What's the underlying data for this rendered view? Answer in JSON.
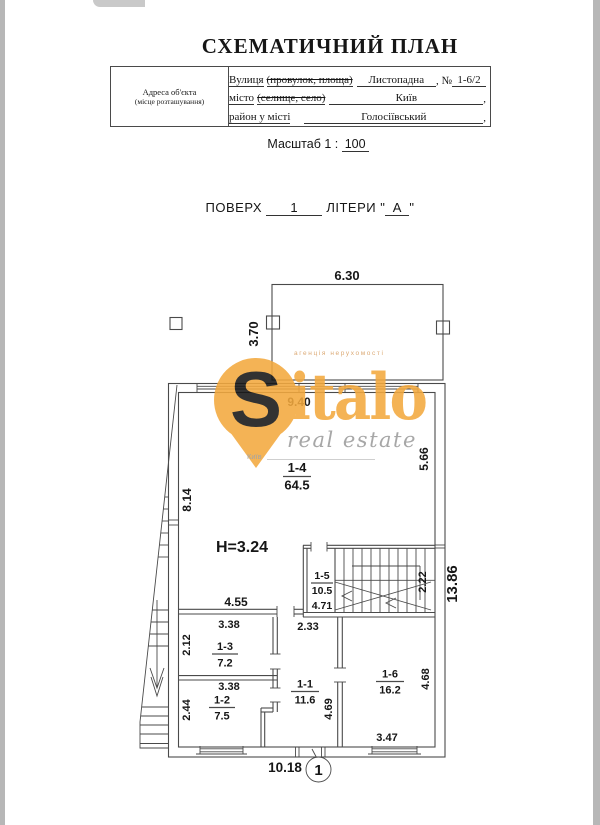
{
  "page": {
    "title": "СХЕМАТИЧНИЙ ПЛАН"
  },
  "address_table": {
    "header_line1": "Адреса об'єкта",
    "header_line2": "(місце розташування)",
    "street_label": "Вулиця",
    "street_struck": "(провулок, площа)",
    "street_value": "Листопадна",
    "street_suffix": ", №",
    "street_number": "1-6/2",
    "city_label": "місто",
    "city_struck": "(селище, село)",
    "city_value": "Київ",
    "city_suffix": ",",
    "district_label": "район у місті",
    "district_value": "Голосіївський",
    "district_suffix": ","
  },
  "scale": {
    "label": "Масштаб 1 :",
    "value": "100"
  },
  "floor": {
    "floor_label": "ПОВЕРХ",
    "floor_value": "1",
    "letters_label": "ЛІТЕРИ",
    "q": "\"",
    "letters_value": "А"
  },
  "watermark": {
    "tagline": "агенція нерухомості",
    "brand_s": "S",
    "brand_rest": "italo",
    "brand_sub": "real estate",
    "city": "Київ",
    "orange": "#f3a93e",
    "gray": "#9c9c9c"
  },
  "plan": {
    "height_label": "H=3.24",
    "marker": "1",
    "terrace": {
      "width": "6.30",
      "depth": "3.70"
    },
    "dims": {
      "top": "9.40",
      "left": "8.14",
      "right": "5.66",
      "right_total": "13.86",
      "stair_width": "2.22",
      "stair_bottom": "4.71",
      "room14_bottom": "4.55",
      "hall_top": "2.33",
      "r13_w": "3.38",
      "r13_d": "2.12",
      "r12_w": "3.38",
      "r12_d": "2.44",
      "r11_d": "4.69",
      "r16_d": "4.68",
      "r16_bottom": "3.47",
      "bottom_total": "10.18"
    },
    "rooms": {
      "r14": {
        "id": "1-4",
        "area": "64.5"
      },
      "r15": {
        "id": "1-5",
        "area": "10.5"
      },
      "r13": {
        "id": "1-3",
        "area": "7.2"
      },
      "r12": {
        "id": "1-2",
        "area": "7.5"
      },
      "r11": {
        "id": "1-1",
        "area": "11.6"
      },
      "r16": {
        "id": "1-6",
        "area": "16.2"
      }
    }
  }
}
